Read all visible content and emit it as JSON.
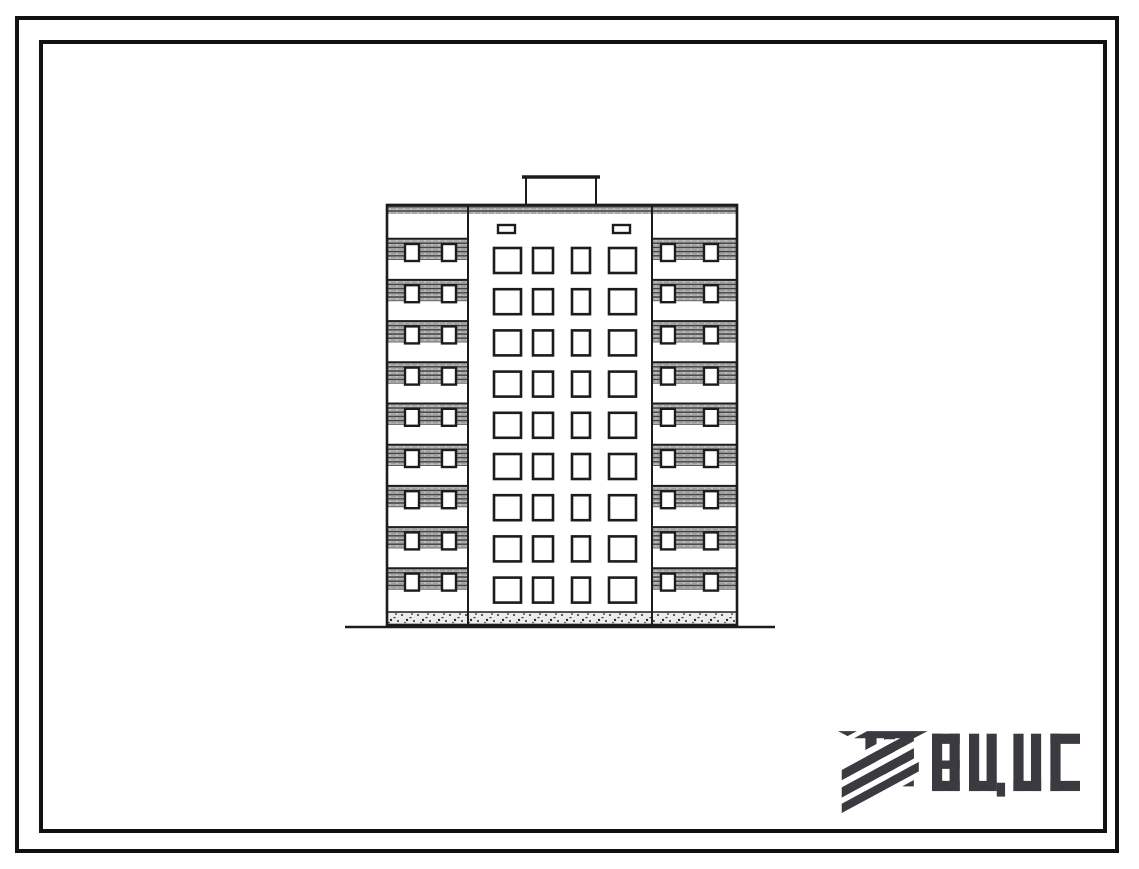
{
  "page": {
    "background": "#ffffff",
    "frame_color": "#111111"
  },
  "drawing": {
    "kind": "building-elevation",
    "floors": 9,
    "ink_color": "#1c1c1c",
    "hatch_color": "#bdbdbd",
    "left_wing": {
      "windows_per_floor": 2,
      "style": "hatched-balcony-bands"
    },
    "center_section": {
      "windows_per_floor": 4,
      "attic_vents": 2,
      "roof_structure": true
    },
    "right_wing": {
      "windows_per_floor": 2,
      "style": "hatched-balcony-bands"
    },
    "foundation": "stippled-strip",
    "ground_line": true
  },
  "logo": {
    "text": "ВЦИС",
    "color": "#3a3a40"
  }
}
